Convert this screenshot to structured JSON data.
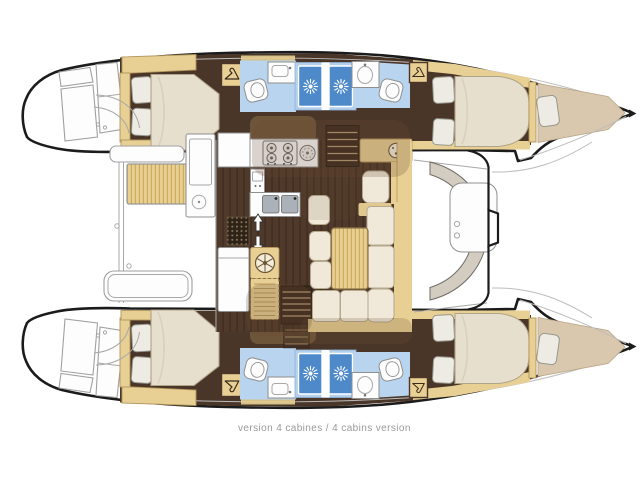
{
  "page": {
    "background_color": "#ffffff"
  },
  "caption": {
    "text": "version 4 cabines / 4 cabins version",
    "color": "#9a9a9a",
    "font_size_px": 10
  },
  "diagram": {
    "type": "floor-plan",
    "subject": "catamaran-yacht-interior-top-view",
    "version_label": "4 cabins",
    "orientation": {
      "bow": "right",
      "stern": "left",
      "hulls": "top-and-bottom"
    },
    "palette": {
      "hull_outline": "#1b1b1b",
      "floor_dark_wood": "#4a3628",
      "furniture_tan": "#e8d094",
      "cushion_cream": "#f0e9da",
      "mattress_cream": "#e7dfcd",
      "forepeak_beige": "#d9c8ad",
      "bathroom_blue": "#b9d4ee",
      "shower_blue": "#4e8aca",
      "shower_frame_blue": "#b3cfec",
      "cockpit_taupe": "#d3ccc1",
      "ghost_brown": "#6e4c31",
      "line_gray": "#a0a0a0"
    },
    "counts": {
      "hulls": 2,
      "double_cabins": 4,
      "forepeak_berths": 2,
      "toilets": 4,
      "shower_stalls": 4,
      "wardrobes": 4,
      "galley_burners": 4,
      "galley_sinks": 2
    },
    "rooms": [
      {
        "name": "saloon",
        "elements": [
          "galley-stove",
          "galley-oven",
          "galley-double-sink",
          "vent-grate",
          "washing-machine",
          "fridge-cabinet",
          "nav-station",
          "dining-table",
          "l-shaped-settee",
          "stools",
          "companionway-stairs-top",
          "companionway-stairs-bottom"
        ]
      },
      {
        "name": "top-hull",
        "elements": [
          "transom-steps",
          "aft-double-cabin",
          "aft-bathroom",
          "shower-stall",
          "forward-bathroom",
          "shower-stall",
          "forward-double-cabin",
          "forepeak-berth"
        ]
      },
      {
        "name": "bottom-hull",
        "elements": [
          "transom-steps",
          "aft-double-cabin",
          "aft-bathroom",
          "shower-stall",
          "forward-bathroom",
          "shower-stall",
          "forward-double-cabin",
          "forepeak-berth"
        ]
      },
      {
        "name": "aft-cockpit",
        "elements": [
          "cockpit-table",
          "cockpit-bench",
          "wetbar-sink"
        ]
      },
      {
        "name": "forward-cockpit",
        "elements": [
          "curved-bench",
          "cockpit-seat"
        ]
      }
    ],
    "icons": [
      "shower-sun-icon",
      "hanger-icon",
      "stove-burner-icon",
      "washing-machine-icon",
      "vent-grate-icon",
      "up-arrow-icon",
      "down-arrow-icon",
      "sink-icon",
      "toilet-icon"
    ]
  }
}
